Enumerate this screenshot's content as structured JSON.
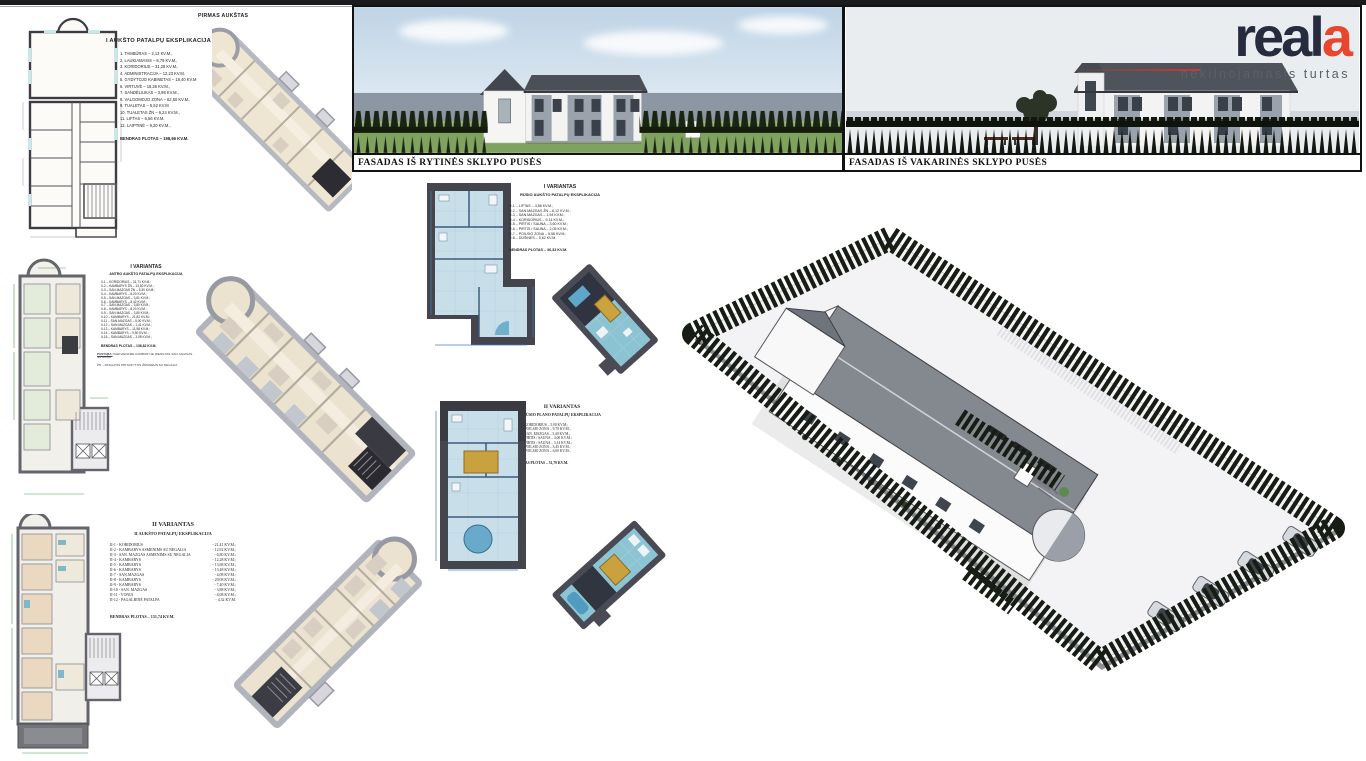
{
  "brand": {
    "logo_main": "real",
    "logo_accent": "a",
    "tagline": "nekilnojamasis turtas"
  },
  "colors": {
    "brand_navy": "#272b3e",
    "brand_red": "#e8462e",
    "tree_green": "#1a2413",
    "plan_blue_floor": "#c8dfe9",
    "sauna_yellow": "#c9a23f"
  },
  "facades": {
    "east_caption": "FASADAS IŠ RYTINĖS SKLYPO PUSĖS",
    "west_caption": "FASADAS IŠ VAKARINĖS SKLYPO PUSĖS"
  },
  "first_floor": {
    "title": "I AUKŠTO PATALPŲ EKSPLIKACIJA",
    "axon_label": "PIRMAS AUKŠTAS",
    "items": [
      "1. TAMBŪRAS – 2,13 KV.M.,",
      "2. LAUKIAMASIS – 8,79 KV.M.,",
      "3. KORIDORIUS – 31,28 KV.M.,",
      "4. ADMINISTRACIJA – 12,23 KV.M.",
      "5. GYDYTOJO KABINETAS – 18,40 KV.M",
      "6. VIRTUVĖ – 18,26 KV.M.,",
      "7. SANDĖLIUKAS – 3,98 KV.M.,",
      "8. VALGOMOJO ZONA – 62,50 KV.M.,",
      "9. TUALETAS – 5,52 KV.M",
      "10. TUALETAS ŽN – 6,24 KV.M.,",
      "11. LIFTAS – 6,56 KV.M.",
      "12. LAIPTINĖ – 9,20 KV.M.,"
    ],
    "total": "BENDRAS PLOTAS – 198,66 KV.M."
  },
  "variant1_floor2": {
    "title": "I VARIANTAS",
    "subtitle": "ANTRO AUKŠTO PATALPŲ EKSPLIKACIJA",
    "items": [
      "II-1 – KORIDORIUS – 31,71 KV.M.;",
      "II-2 – KAMBARYS ŽN – 13,50 KV.M.;",
      "II-3 – SAN.MAZGAS ŽN – 5,30 KV.M.;",
      "II-4 – KAMBARYS – 8,20 KV.M.;",
      "II-5 – SAN.MAZGAS – 3,61 KV.M.;",
      "II-6 – KAMBARYS – 8,42 KV.M.;",
      "II-7 – SAN.MAZGAS – 3,80 KV.M.;",
      "II-8 – KAMBARYS – 8,20 KV.M.;",
      "II-9 – SAN.MAZGAS – 3,80 KV.M.;",
      "II-10 – KAMBARYS – 21,82 KV.M.;",
      "II-11 – SAN.MAZGAS – 5,00 KV.M.;",
      "II-12 – SAN.MAZGAS – 1,41 KV.M.;",
      "II-13 – KAMBARYS – 11,58 KV.M.;",
      "II-14 – KAMBARYS – 9,50 KV.M.;",
      "II-15 – SAN.MAZGAS – 3,08 KV.M.;"
    ],
    "total": "BENDRAS PLOTAS – 138,82 KV.M.",
    "note_label": "PASTABA:",
    "note": "KIEKVIENAME KAMBARYJE ĮRENGTAS SAN. MAZGAS SU DUŠU",
    "note2": "ŽN – PATALPOS PRITAIKYTOS ŽMONĖMS SU NEGALIA"
  },
  "variant1_basement": {
    "title": "I VARIANTAS",
    "subtitle": "RŪSIO AUKŠTO PATALPŲ EKSPLIKACIJA",
    "items": [
      "R-1 – LIFTAS – 4,56 KV.M.;",
      "R-2 – SAN.MAZGAS ŽN – 6,12 KV.M.;",
      "R-3 – SAN.MAZGAS – 1,94 KV.M.;",
      "R-4 – KORIDORIUS – 9,14 KV.M.;",
      "R-5 – PIRTIS / SAUNA – 3,60 KV.M.;",
      "R-6 – PIRTIS / SAUNA – 2,05 KV.M.;",
      "R-7 – POILSIO ZONA – 5,58 KV.M.;",
      "R-8 – DŪŠINĖS – 5,62 KV.M."
    ],
    "total": "BENDRAS PLOTAS – 36,33 KV.M."
  },
  "variant2_basement": {
    "title": "II VARIANTAS",
    "subtitle": "RŪSIO PLANO PATALPŲ EKSPLIKACIJA",
    "items": [
      "1. R-1 – KORIDORIUS – 5,00 KV.M.;",
      "2. R-2 – POILSIO ZONA – 9,70 KV.M.;",
      "3. R-3 – SAN. MAZGAS – 5,40 KV.M.;",
      "4. R-4 – PIRTIS / SAUNA – 4,00 KV.M.;",
      "5. R-5 – PIRTIS / SAUNA – 3,14 KV.M.;",
      "6. R-6 – POILSIO ZONA – 3,45 KV.M.;",
      "7. R-7 – POILSIO ZONA – 6,00 KV.M.;"
    ],
    "total": "BENDRAS PLOTAS – 51,79 KV.M."
  },
  "variant2_floor2": {
    "title": "II VARIANTAS",
    "subtitle": "II AUKŠTO PATALPŲ EKSPLIKACIJA",
    "items": [
      {
        "label": "II-1 - KORIDORIUS",
        "value": "- 21,41 KV.M.;"
      },
      {
        "label": "II-2 - KAMBARYS ASMENIMS SU NEGALIA",
        "value": "- 12,92 KV.M.;"
      },
      {
        "label": "II-3 - SAN. MAZGAS ASMENIMS SU NEGALIA",
        "value": "- 6,80 KV.M.;"
      },
      {
        "label": "II-4 - KAMBARYS",
        "value": "- 12,28 KV.M.;"
      },
      {
        "label": "II-5 - KAMBARYS",
        "value": "- 13,68 KV.M.;"
      },
      {
        "label": "II-6 - KAMBARYS",
        "value": "- 13,48 KV.M.;"
      },
      {
        "label": "II-7 - SAN.MAZGAS",
        "value": "- 4,08 KV.M.;"
      },
      {
        "label": "II-8 - KAMBARYS",
        "value": "- 29,08 KV.M.;"
      },
      {
        "label": "II-9 - KAMBARYS",
        "value": "- 7,40 KV.M.;"
      },
      {
        "label": "II-10 - SAN. MAZGAS",
        "value": "- 3,88 KV.M.;"
      },
      {
        "label": "II-11 - VONIA",
        "value": "- 4,08 KV.M.;"
      },
      {
        "label": "II-12 - PAGALBINĖ PATALPA",
        "value": "- 4,32 KV.M."
      }
    ],
    "total": "BENDRAS PLOTAS – 131,74 KV.M."
  }
}
